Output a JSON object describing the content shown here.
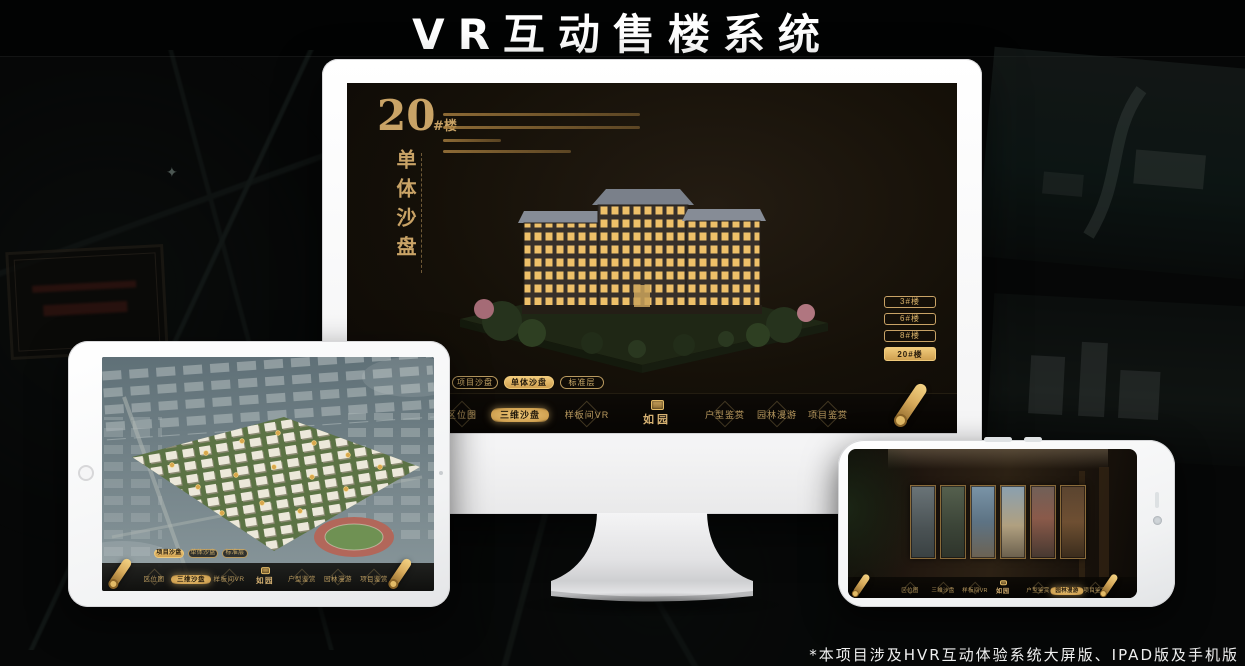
{
  "page": {
    "title": "VR互动售楼系统",
    "footnote": "*本项目涉及HVR互动体验系统大屏版、IPAD版及手机版"
  },
  "colors": {
    "gold": "#C9A366",
    "gold_bright": "#EDC778",
    "gold_dark": "#8A6B3A",
    "screen_bg": "#16110B",
    "navbar_bg": "#0B0805",
    "active_text": "#241A0C",
    "title_text": "#FFFFFF"
  },
  "brand": {
    "logo_text": "如园",
    "seal_icon": "seal-stamp-icon"
  },
  "nav": {
    "scroll_icon": "scroll-menu-icon",
    "items": [
      {
        "label": "区位图"
      },
      {
        "label": "三维沙盘"
      },
      {
        "label": "样板间VR"
      },
      {
        "label": "户型鉴赏"
      },
      {
        "label": "园林漫游"
      },
      {
        "label": "项目鉴赏"
      }
    ]
  },
  "subtabs": [
    {
      "label": "项目沙盘"
    },
    {
      "label": "单体沙盘"
    },
    {
      "label": "标准层"
    }
  ],
  "monitor": {
    "headline_number": "20",
    "headline_unit": "#楼",
    "headline_vertical": "单体沙盘",
    "active_building": "20#楼",
    "active_subtab": "单体沙盘",
    "active_nav": "三维沙盘",
    "building_buttons": [
      {
        "label": "3#楼"
      },
      {
        "label": "6#楼"
      },
      {
        "label": "8#楼"
      },
      {
        "label": "20#楼"
      }
    ]
  },
  "tablet": {
    "active_subtab": "项目沙盘",
    "active_nav": "三维沙盘"
  },
  "phone": {
    "active_nav": "园林漫游"
  }
}
